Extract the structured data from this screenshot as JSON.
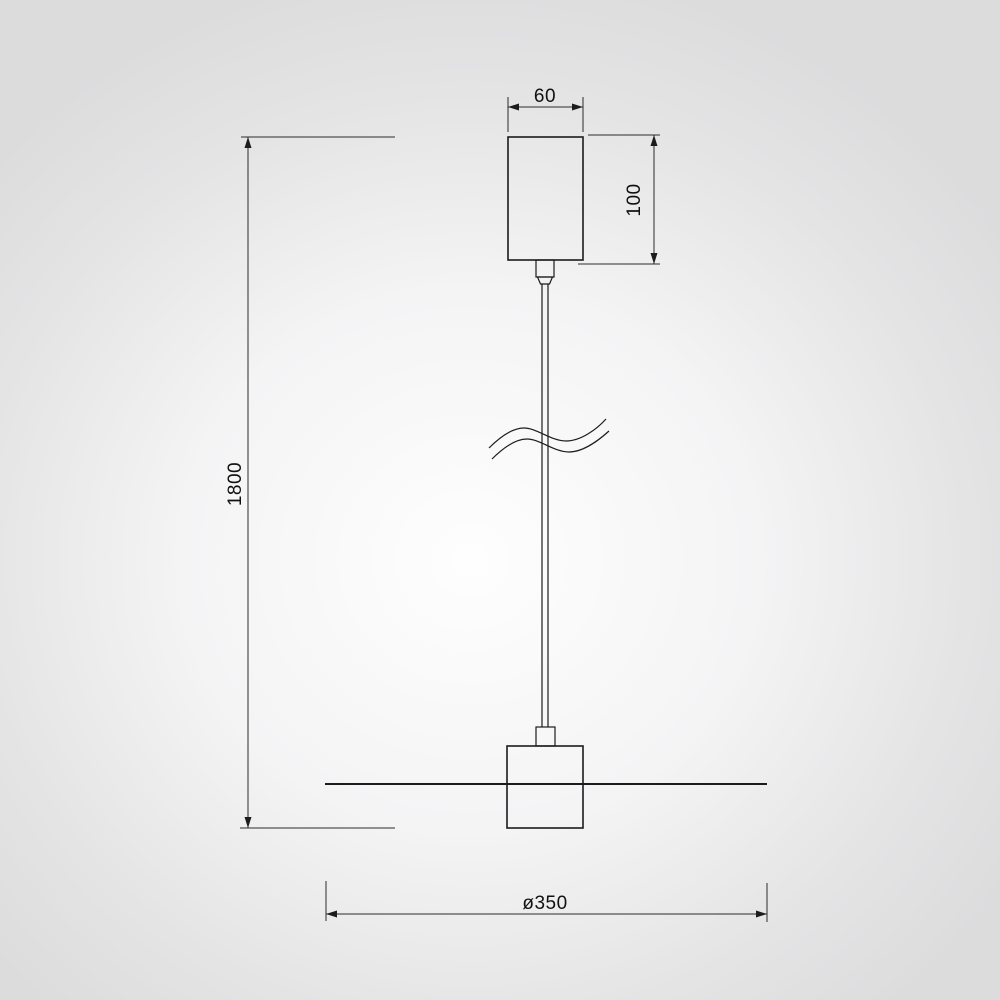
{
  "drawing": {
    "kind": "pendant-lamp-dimension-drawing",
    "dimensions": {
      "canopy_width": "60",
      "canopy_height": "100",
      "drop_height": "1800",
      "shade_diameter": "ø350"
    },
    "colors": {
      "line": "#1c1c1c",
      "background_center": "#fefefe",
      "background_edge": "#dcdcdd"
    }
  }
}
